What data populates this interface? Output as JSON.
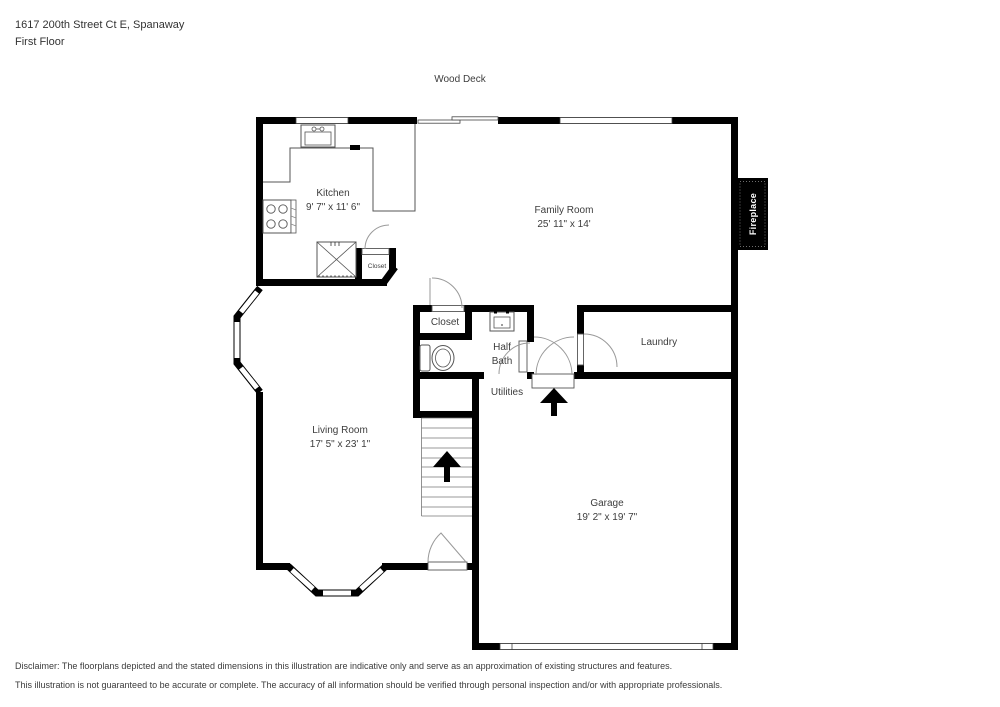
{
  "header": {
    "address": "1617 200th Street Ct E, Spanaway",
    "floor_label": "First Floor"
  },
  "plan": {
    "wood_deck_label": "Wood Deck",
    "kitchen": {
      "name": "Kitchen",
      "dims": "9' 7\" x 11' 6\""
    },
    "family_room": {
      "name": "Family Room",
      "dims": "25' 11\" x 14'"
    },
    "living_room": {
      "name": "Living Room",
      "dims": "17' 5\" x 23' 1\""
    },
    "garage": {
      "name": "Garage",
      "dims": "19' 2\" x 19' 7\""
    },
    "kitchen_closet_label": "Closet",
    "hall_closet_label": "Closet",
    "half_bath_label": "Half Bath",
    "laundry_label": "Laundry",
    "utilities_label": "Utilities",
    "fireplace_label": "Fireplace"
  },
  "disclaimer": {
    "line1": "Disclaimer: The floorplans depicted and the stated dimensions in this illustration are indicative only and serve as an approximation of existing structures and features.",
    "line2": "This illustration is not guaranteed to be accurate or complete. The accuracy of all information should be verified through personal inspection and/or with appropriate professionals."
  },
  "colors": {
    "wall": "#000000",
    "thin_line": "#555555",
    "arc_line": "#999999",
    "background": "#ffffff"
  }
}
